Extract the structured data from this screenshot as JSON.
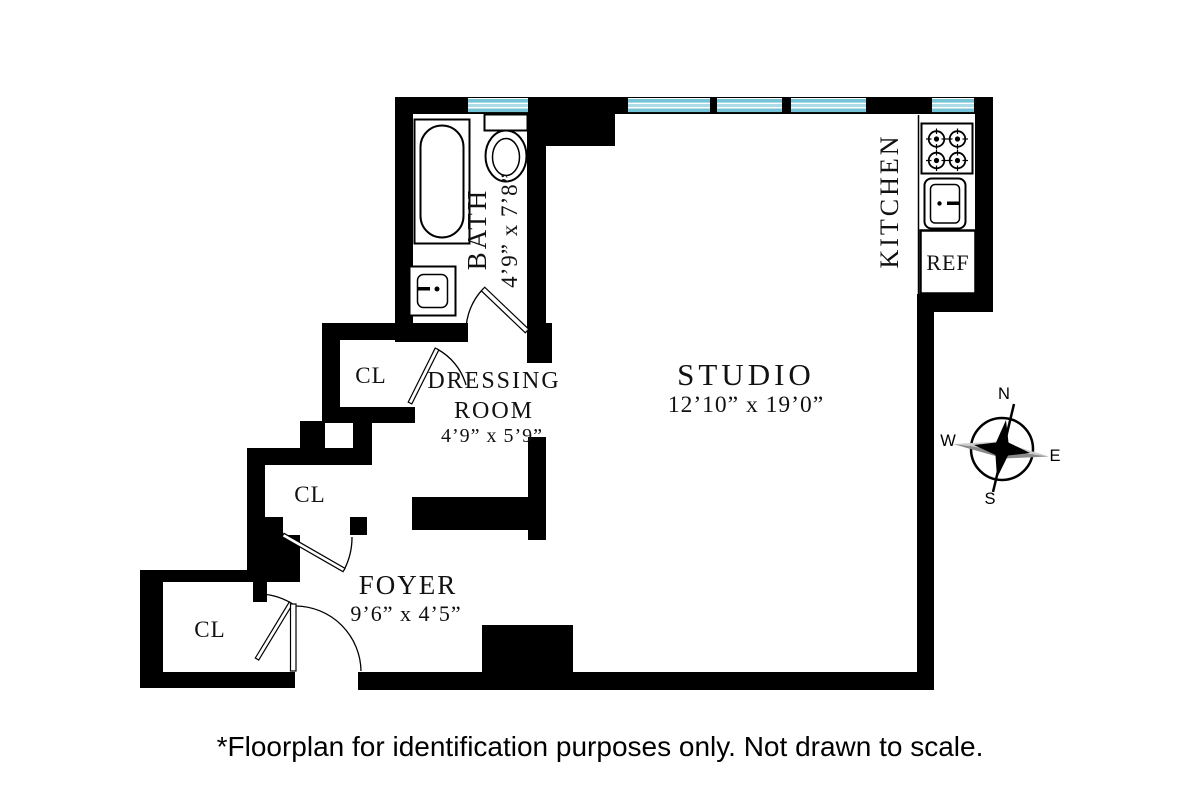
{
  "plan": {
    "rooms": {
      "bath": {
        "name": "BATH",
        "dims": "4’9” x 7’8”"
      },
      "kitchen": {
        "name": "KITCHEN"
      },
      "ref": {
        "label": "REF"
      },
      "studio": {
        "name": "STUDIO",
        "dims": "12’10” x 19’0”"
      },
      "dressing": {
        "line1": "DRESSING",
        "line2": "ROOM",
        "dims": "4’9” x 5’9”"
      },
      "foyer": {
        "name": "FOYER",
        "dims": "9’6” x 4’5”"
      },
      "closet_dressing": {
        "label": "CL"
      },
      "closet_foyer_upper": {
        "label": "CL"
      },
      "closet_foyer_lower": {
        "label": "CL"
      }
    },
    "compass": {
      "n": "N",
      "s": "S",
      "e": "E",
      "w": "W"
    },
    "colors": {
      "wall": "#000000",
      "window_glass_dark": "#74c3d6",
      "window_glass_light": "#aadbe7"
    }
  },
  "footer": {
    "disclaimer": "*Floorplan for identification purposes only. Not drawn to scale."
  }
}
